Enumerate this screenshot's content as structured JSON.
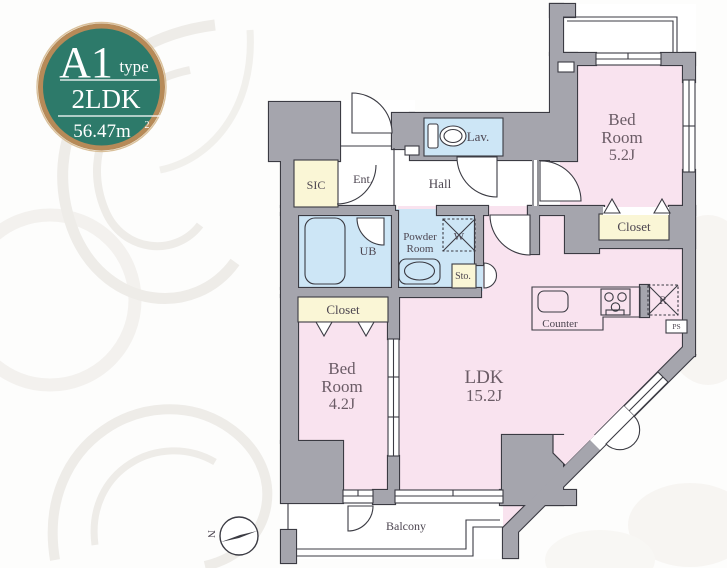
{
  "badge": {
    "unit": "A1",
    "unit_suffix": "type",
    "plan_type": "2LDK",
    "area": "56.47m",
    "area_exp": "2"
  },
  "labels": {
    "bedroom1_l1": "Bed",
    "bedroom1_l2": "Room",
    "bedroom1_l3": "5.2J",
    "bedroom2_l1": "Bed",
    "bedroom2_l2": "Room",
    "bedroom2_l3": "4.2J",
    "ldk_l1": "LDK",
    "ldk_l2": "15.2J",
    "closet_top": "Closet",
    "closet_left": "Closet",
    "lav": "Lav.",
    "hall": "Hall",
    "ent": "Ent.",
    "sic": "SIC",
    "ub": "UB",
    "powder_l1": "Powder",
    "powder_l2": "Room",
    "sto": "Sto.",
    "counter": "Counter",
    "washer": "W",
    "fridge": "R",
    "ps": "PS",
    "balcony": "Balcony",
    "compass_north": "N"
  },
  "colors": {
    "wall": "#a5a5ad",
    "outline": "#3b3b43",
    "room_pink": "#f9e3ef",
    "wet_blue": "#cde6f6",
    "storage_cream": "#faf6d6",
    "badge_teal": "#2d7a6a",
    "badge_ring": "#b68a58",
    "pattern": "#eceae6"
  }
}
